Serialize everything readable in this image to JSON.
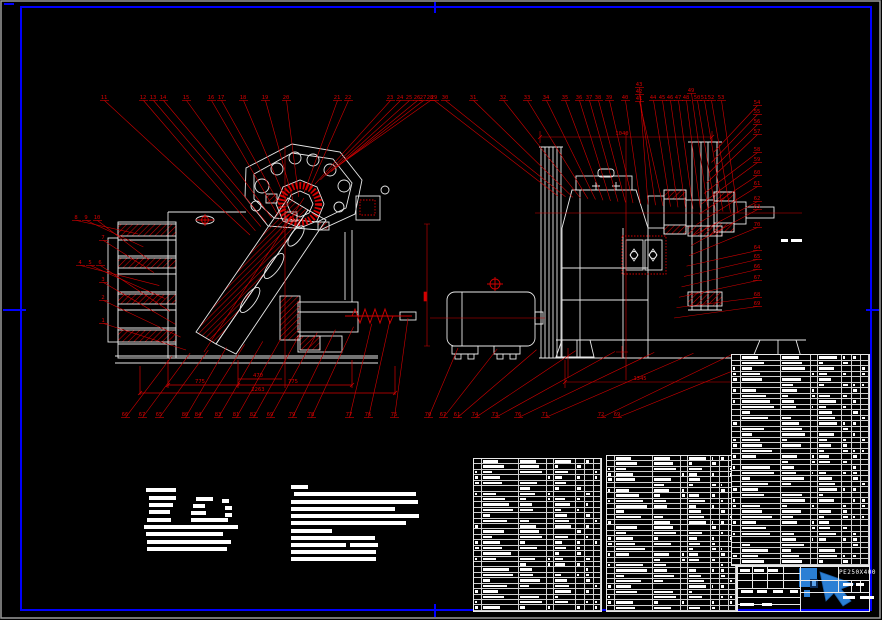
{
  "colors": {
    "bg": "#000000",
    "frame": "#0000ff",
    "lines": "#e8e8e8",
    "accent": "#d40000",
    "overlay_blue": "#2b7fd4"
  },
  "title_block": {
    "model": "PE250X400"
  },
  "callouts": [
    {
      "name": "front-top",
      "y": 99,
      "fan": [
        250,
        235,
        342,
        163
      ],
      "labels": [
        [
          "11",
          104
        ],
        [
          "12",
          143
        ],
        [
          "13",
          153
        ],
        [
          "14",
          163
        ],
        [
          "15",
          186
        ],
        [
          "16",
          211
        ],
        [
          "17",
          221
        ],
        [
          "18",
          243
        ],
        [
          "19",
          265
        ],
        [
          "20",
          286
        ],
        [
          "21",
          337
        ],
        [
          "22",
          348
        ],
        [
          "23",
          390
        ],
        [
          "24",
          400
        ],
        [
          "25",
          409
        ],
        [
          "26",
          417
        ],
        [
          "27",
          423
        ],
        [
          "28",
          430
        ]
      ]
    },
    {
      "name": "front-left",
      "y": 219,
      "fan": [
        138,
        234,
        186,
        350
      ],
      "labels": [
        [
          "8",
          76
        ],
        [
          "9",
          86
        ],
        [
          "10",
          97
        ],
        [
          "7",
          103,
          239
        ],
        [
          "4",
          80,
          264
        ],
        [
          "5",
          90,
          264
        ],
        [
          "6",
          100,
          264
        ],
        [
          "3",
          103,
          281
        ],
        [
          "2",
          103,
          299
        ],
        [
          "1",
          103,
          322
        ]
      ]
    },
    {
      "name": "front-bottom",
      "y": 416,
      "fan": [
        172,
        356,
        408,
        318
      ],
      "labels": [
        [
          "66",
          125
        ],
        [
          "67",
          142
        ],
        [
          "65",
          159
        ],
        [
          "80",
          185
        ],
        [
          "84",
          198
        ],
        [
          "83",
          218
        ],
        [
          "81",
          236
        ],
        [
          "82",
          253
        ],
        [
          "69",
          270
        ],
        [
          "79",
          292
        ],
        [
          "78",
          311
        ],
        [
          "77",
          349
        ],
        [
          "76",
          368
        ],
        [
          "75",
          394
        ]
      ]
    },
    {
      "name": "side-top",
      "y": 99,
      "fan": [
        558,
        196,
        738,
        213
      ],
      "labels": [
        [
          "29",
          434
        ],
        [
          "30",
          445
        ],
        [
          "31",
          473
        ],
        [
          "32",
          503
        ],
        [
          "33",
          527
        ],
        [
          "34",
          546
        ],
        [
          "35",
          565
        ],
        [
          "36",
          579
        ],
        [
          "37",
          589
        ],
        [
          "38",
          598
        ],
        [
          "39",
          609
        ],
        [
          "40",
          625
        ],
        [
          "43",
          639,
          86
        ],
        [
          "42",
          639,
          93
        ],
        [
          "41",
          639,
          100
        ],
        [
          "44",
          653
        ],
        [
          "45",
          662
        ],
        [
          "46",
          670
        ],
        [
          "47",
          678
        ],
        [
          "48",
          686
        ],
        [
          "49",
          691,
          92
        ],
        [
          "50",
          697
        ],
        [
          "51",
          704
        ],
        [
          "52",
          711
        ],
        [
          "53",
          721
        ]
      ]
    },
    {
      "name": "side-right",
      "y": 104,
      "fan": [
        714,
        152,
        674,
        318
      ],
      "labels": [
        [
          "54",
          757
        ],
        [
          "55",
          757,
          113
        ],
        [
          "56",
          757,
          123
        ],
        [
          "57",
          757,
          133
        ],
        [
          "58",
          757,
          151
        ],
        [
          "59",
          757,
          161
        ],
        [
          "60",
          757,
          174
        ],
        [
          "61",
          757,
          185
        ],
        [
          "62",
          757,
          200
        ],
        [
          "63",
          757,
          208
        ],
        [
          "70",
          757,
          226
        ],
        [
          "64",
          757,
          249
        ],
        [
          "65",
          757,
          258
        ],
        [
          "66",
          757,
          268
        ],
        [
          "67",
          757,
          279
        ],
        [
          "68",
          757,
          296
        ],
        [
          "69",
          757,
          305
        ]
      ]
    },
    {
      "name": "side-bottom",
      "y": 416,
      "fan": [
        458,
        348,
        772,
        355
      ],
      "labels": [
        [
          "70",
          428
        ],
        [
          "67",
          443
        ],
        [
          "61",
          457
        ],
        [
          "74",
          475
        ],
        [
          "73",
          495
        ],
        [
          "76",
          518
        ],
        [
          "71",
          545
        ],
        [
          "72",
          601
        ],
        [
          "69",
          617
        ]
      ]
    }
  ],
  "dims": [
    [
      "775",
      200,
      383
    ],
    [
      "470",
      258,
      377
    ],
    [
      "775",
      293,
      383
    ],
    [
      "2263",
      258,
      391
    ],
    [
      "1040",
      622,
      135
    ],
    [
      "1345",
      640,
      380
    ]
  ],
  "micro_labels": [
    [
      781,
      239,
      7
    ],
    [
      791,
      239,
      11
    ]
  ],
  "notes_left": {
    "bars": [
      [
        146,
        488,
        30
      ],
      [
        149,
        496,
        27
      ],
      [
        196,
        497,
        17
      ],
      [
        222,
        499,
        7
      ],
      [
        149,
        503,
        24
      ],
      [
        193,
        504,
        12
      ],
      [
        225,
        506,
        7
      ],
      [
        149,
        510,
        21
      ],
      [
        191,
        511,
        15
      ],
      [
        225,
        513,
        7
      ],
      [
        147,
        518,
        24
      ],
      [
        191,
        518,
        37
      ],
      [
        144,
        525,
        94
      ],
      [
        146,
        532,
        77
      ],
      [
        147,
        540,
        84
      ],
      [
        147,
        547,
        80
      ]
    ]
  },
  "notes_right": {
    "bars": [
      [
        291,
        485,
        17
      ],
      [
        294,
        492,
        122
      ],
      [
        291,
        500,
        127
      ],
      [
        291,
        507,
        104
      ],
      [
        291,
        514,
        128
      ],
      [
        291,
        521,
        115
      ],
      [
        291,
        529,
        41
      ],
      [
        291,
        536,
        84
      ],
      [
        291,
        543,
        55
      ],
      [
        350,
        543,
        28
      ],
      [
        291,
        550,
        85
      ],
      [
        291,
        557,
        85
      ]
    ]
  },
  "bom": {
    "bar_pattern": [
      0.85,
      0.5,
      0.7,
      0.35,
      0.9,
      0.6,
      0.75,
      0.45,
      0.65,
      0.8,
      0.55,
      0.3
    ],
    "cols": [
      0.065,
      0.29,
      0.22,
      0.055,
      0.175,
      0.07,
      0.07,
      0.055
    ],
    "tables": [
      {
        "x": 473,
        "y": 458,
        "w": 129,
        "h": 154,
        "rows": 28
      },
      {
        "x": 606,
        "y": 455,
        "w": 131,
        "h": 157,
        "rows": 29
      },
      {
        "x": 731,
        "y": 354,
        "w": 139,
        "h": 212,
        "rows": 38
      }
    ]
  },
  "title_bars": [
    [
      740,
      569,
      10
    ],
    [
      754,
      569,
      10
    ],
    [
      768,
      569,
      10
    ],
    [
      741,
      590,
      12
    ],
    [
      757,
      590,
      10
    ],
    [
      773,
      590,
      10
    ],
    [
      790,
      590,
      8
    ],
    [
      843,
      583,
      10
    ],
    [
      856,
      583,
      8
    ],
    [
      843,
      596,
      12
    ],
    [
      860,
      596,
      14
    ],
    [
      740,
      603,
      14
    ],
    [
      762,
      603,
      10
    ]
  ]
}
